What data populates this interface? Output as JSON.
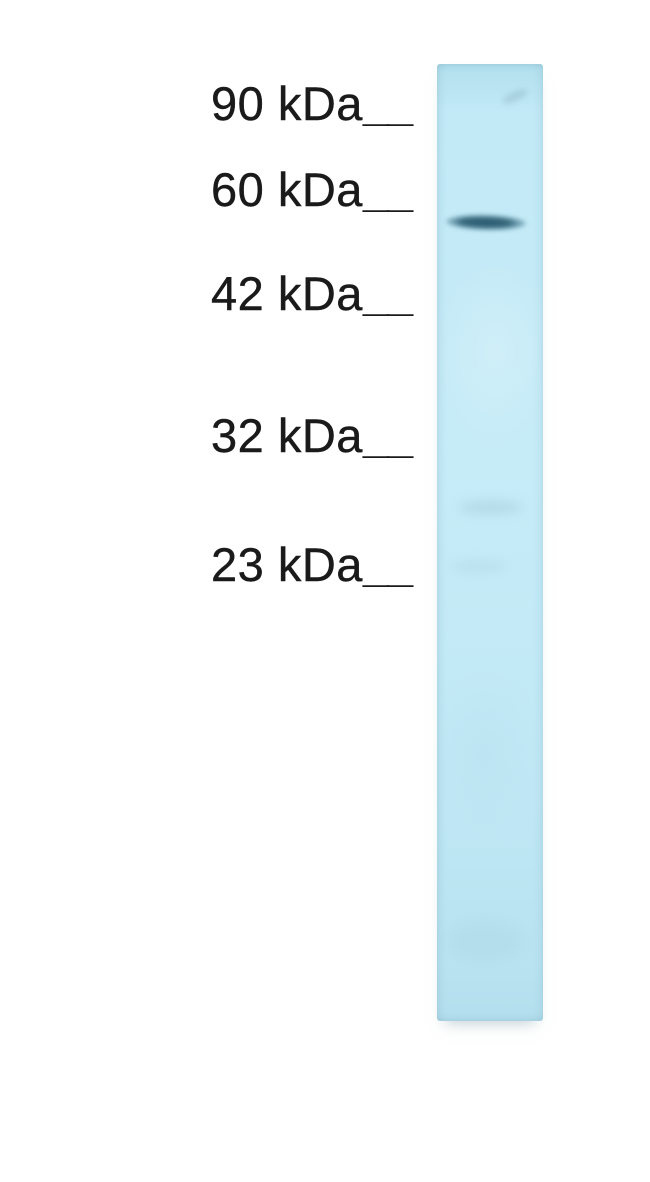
{
  "page": {
    "background_color": "#ffffff",
    "text_color": "#1a1a1a"
  },
  "blot": {
    "lane_color": "#c3e9f6",
    "lane_edge_color": "#a9d8ea",
    "band_color": "#2d5d72",
    "band_present": true
  },
  "markers": [
    {
      "label": "90 kDa",
      "tick": "__"
    },
    {
      "label": "60 kDa",
      "tick": "__"
    },
    {
      "label": "42 kDa",
      "tick": "__"
    },
    {
      "label": "32 kDa",
      "tick": "__"
    },
    {
      "label": "23 kDa",
      "tick": "__"
    }
  ]
}
